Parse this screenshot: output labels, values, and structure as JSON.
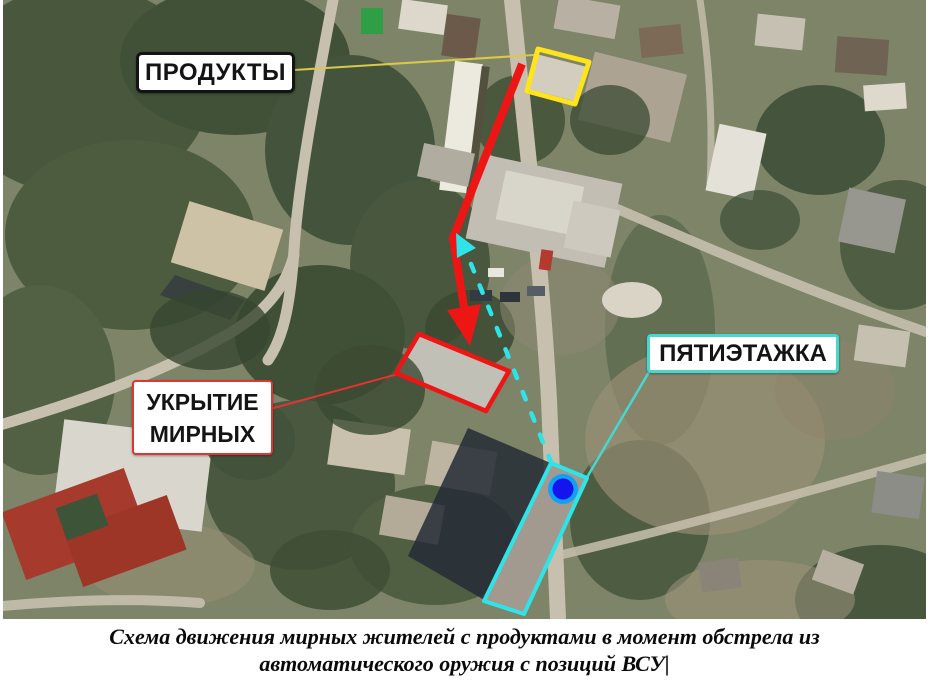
{
  "labels": {
    "products": {
      "text": "ПРОДУКТЫ"
    },
    "shelter": {
      "line1": "УКРЫТИЕ",
      "line2": "МИРНЫХ"
    },
    "five_story": {
      "text": "ПЯТИЭТАЖКА"
    }
  },
  "caption": {
    "line1": "Схема движения мирных жителей с продуктами в момент обстрела из",
    "line2": "автоматического оружия с позиций ВСУ|"
  },
  "colors": {
    "highlight_yellow": "#ffe41c",
    "connector_yellow": "#d9c84b",
    "route_red": "#ee1515",
    "label_border_red": "#e23434",
    "route_cyan": "#2ee4e8",
    "label_border_cyan": "#45d7d0",
    "label_border_black": "#141414",
    "marker_blue_ring": "#12a0f6",
    "marker_blue_inner": "#1414ee"
  }
}
